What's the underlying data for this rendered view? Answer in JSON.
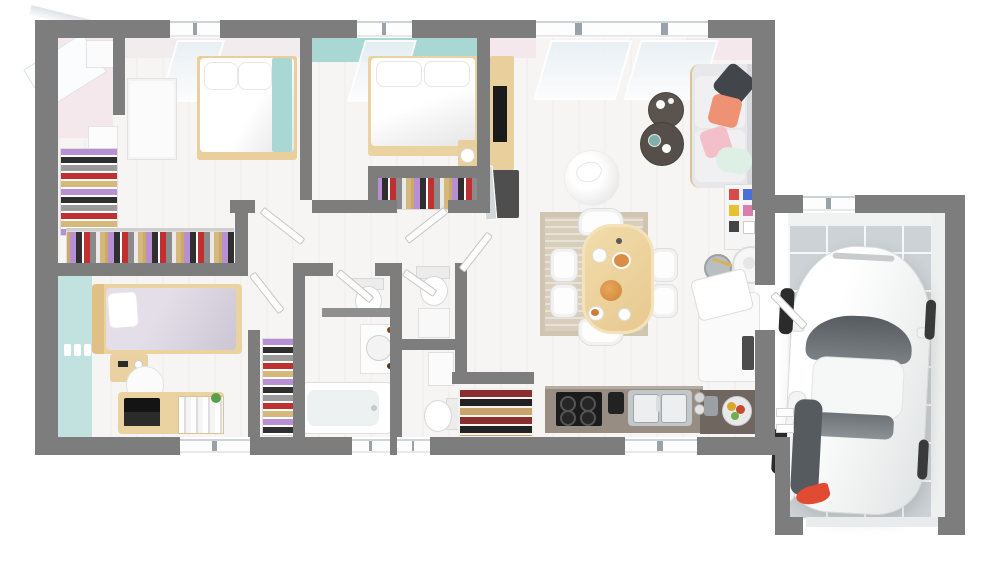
{
  "meta": {
    "title": "3D top-down floor plan of a single-storey house with attached garage",
    "type": "architectural-3d-floor-plan",
    "visible_text": "none"
  },
  "palette": {
    "wall": "#7d7d7d",
    "floor": "#f6f5f3",
    "garage-floor": "#ccd2d5",
    "teal": "#a9d8d4",
    "teal-light": "#c2e2e0",
    "pink": "#f5e8ec",
    "wood": "#e8cf9b",
    "wood-light": "#ead2a1",
    "sofa": "#e8e8ea",
    "pillow-dark": "#42464b",
    "pillow-coral": "#ef9273",
    "pillow-pink": "#f3c0ca",
    "pillow-mint": "#def0e5",
    "rug": "#d8cebb",
    "counter": "#978d83",
    "counter-dark": "#6e665f",
    "appliance": "#1b1b1b",
    "car-glass": "#565b5f",
    "car-red": "#e14b31",
    "cloth-purple": "#b98fd4",
    "cloth-red": "#c03030",
    "cloth-black": "#2f2f2f",
    "cloth-tan": "#d6b87a"
  },
  "rooms": [
    {
      "id": "bedroom-1",
      "position": "top-left",
      "furniture": [
        "double-bed-white-teal-throw",
        "white-wardrobe",
        "dresser",
        "leaning-mirror"
      ]
    },
    {
      "id": "dressing",
      "position": "left",
      "furniture": [
        "folded-clothes-shelves",
        "hanging-clothes-rail"
      ]
    },
    {
      "id": "bedroom-2",
      "position": "top-middle",
      "accent_wall": "teal",
      "furniture": [
        "double-bed-wood-frame",
        "closet-hanging-clothes",
        "bedside-shelf"
      ]
    },
    {
      "id": "bedroom-3",
      "position": "bottom-left",
      "accent_wall": "teal-light",
      "furniture": [
        "single-bed-lavender",
        "nightstand",
        "desk-with-laptop",
        "white-chair",
        "wardrobe-shelves"
      ]
    },
    {
      "id": "hallway",
      "position": "center",
      "furniture": [
        "open-doors"
      ]
    },
    {
      "id": "bathroom",
      "position": "center-bottom",
      "furniture": [
        "toilet",
        "wall-shelf",
        "vanity-sink",
        "bathtub"
      ]
    },
    {
      "id": "wc",
      "position": "center",
      "furniture": [
        "toilet",
        "small-cabinet"
      ]
    },
    {
      "id": "wc-2",
      "position": "center-bottom",
      "furniture": [
        "toilet",
        "shoe-shelf"
      ]
    },
    {
      "id": "living-dining",
      "position": "right",
      "accent_wall": "pink",
      "furniture": [
        "sofa-4-pillows",
        "coffee-table-x2",
        "white-pouf",
        "tv-media-column",
        "dark-sideboard",
        "dining-table-6-chairs",
        "striped-rug"
      ]
    },
    {
      "id": "kitchen",
      "position": "bottom-right",
      "furniture": [
        "hob-4-burners",
        "coffee-machine",
        "double-sink",
        "jars",
        "fruit-bowl"
      ]
    },
    {
      "id": "utility",
      "position": "right",
      "furniture": [
        "laundry-shelf",
        "water-heater",
        "washing-machine-open-lid",
        "dark-counter-with-mixer"
      ]
    },
    {
      "id": "garage",
      "position": "far-right",
      "furniture": [
        "white-car-red-accent",
        "tiled-floor"
      ]
    }
  ]
}
